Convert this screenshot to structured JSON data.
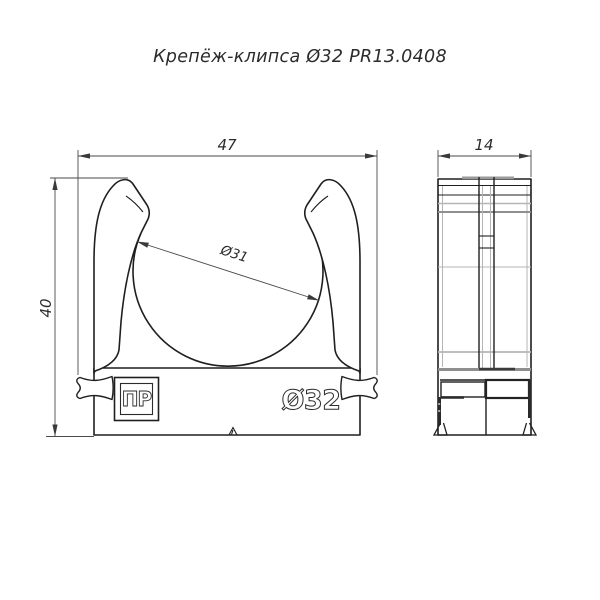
{
  "title": "Крепёж-клипса Ø32 PR13.0408",
  "front_view": {
    "dim_width": "47",
    "dim_height": "40",
    "dim_inner_diameter": "Ø31",
    "embossed_label": "Ø32",
    "logo_text": "ПР"
  },
  "side_view": {
    "dim_depth": "14"
  },
  "colors": {
    "line": "#1f1f1f",
    "dimension": "#4a4a4a",
    "mold_line_light": "#b5b5b5",
    "mold_line_dark": "#8f8f8f",
    "background": "#ffffff"
  }
}
